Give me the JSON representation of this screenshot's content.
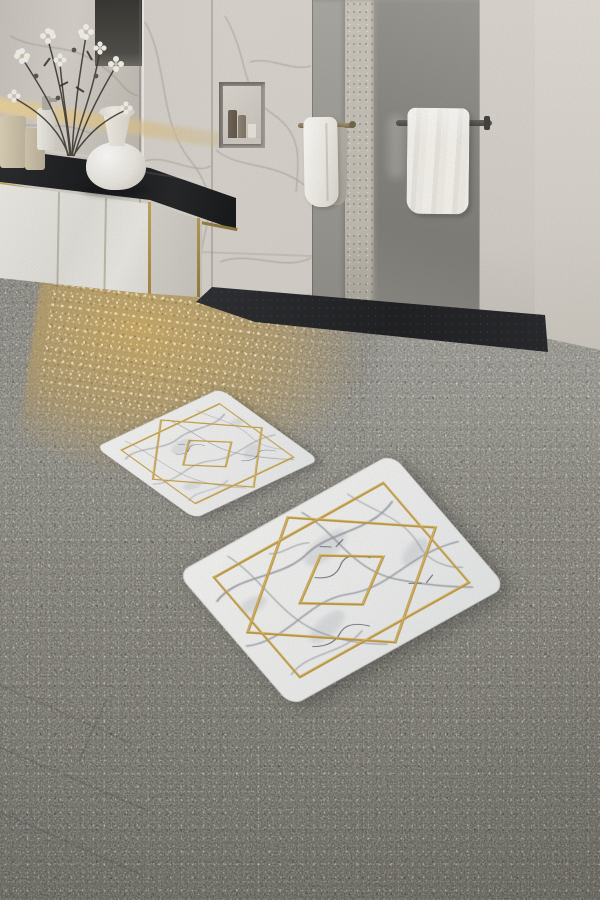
{
  "scene": {
    "type": "product-photo",
    "subject": "Two-piece bath mat set with white marble pattern and gold geometric diamond design",
    "setting": "Modern bathroom with beige marble walls, black-counter vanity, walk-in shower and speckled grey terrazzo floor"
  },
  "labels": {
    "scene": "Modern bathroom with two-piece marble gold bath mat set on terrazzo floor",
    "wall": "Beige marble tiled wall with grey veining",
    "mirror": "Vanity mirror reflecting marble wall",
    "flowers": "White daisy flowers with dark stems",
    "vase": "White ceramic vase",
    "toiletries": "Toiletry bottles and soap dispenser on countertop",
    "countertop": "Black marble vanity countertop with gold edge trim",
    "cabinet": "White gloss vanity cabinet with gold trim",
    "shelf_towels": "Folded white towels in open cabinet shelf",
    "towel_stack": "Stack of folded beige towels on lower shelf",
    "niche": "Recessed shower wall niche with toiletry bottles",
    "hanging_towel_left": "White towel hanging on brass rail",
    "hanging_towel_right": "White towel hanging on dark rail",
    "glass_mid": "Grey reflective panel",
    "pillar": "Speckled stone pillar",
    "glass_right": "Grey glass shower panel",
    "shower_floor": "Dark charcoal shower floor",
    "floor": "Speckled grey terrazzo bathroom floor",
    "gold_glow": "Warm golden light reflection on floor near vanity",
    "mat_small": "Small bath mat, white marble pattern with gold diamond design",
    "mat_large": "Large bath mat, white marble pattern with gold diamond design"
  },
  "mat_set": {
    "pieces": 2,
    "design": {
      "base": "white marble with grey veining",
      "accent": "gold lines",
      "motifs": [
        "inset rectangle frame",
        "large overlapping diamond",
        "small center diamond"
      ],
      "corner_style": "rounded"
    }
  },
  "palette": {
    "wall_marble": "#d8d4cd",
    "wall_vein": "#8f8a82",
    "mirror_dark_band": "#35332f",
    "backsplash_glow": "#eccf97",
    "counter_black": "#17181b",
    "cabinet_white": "#eae8e2",
    "gold_trim": "#b9994f",
    "towel_white": "#f3f1ea",
    "towel_beige": "#e9e3d4",
    "glass_grey": "#8a8984",
    "stone_pillar": "#c5c1b7",
    "shower_floor_dark": "#1d1e21",
    "floor_terrazzo": "#a19f96",
    "floor_gold_glow": "#cfaa5c",
    "mat_marble": "#f6f5f3",
    "mat_vein": "#878c96",
    "mat_gold": "#c39a3c"
  }
}
